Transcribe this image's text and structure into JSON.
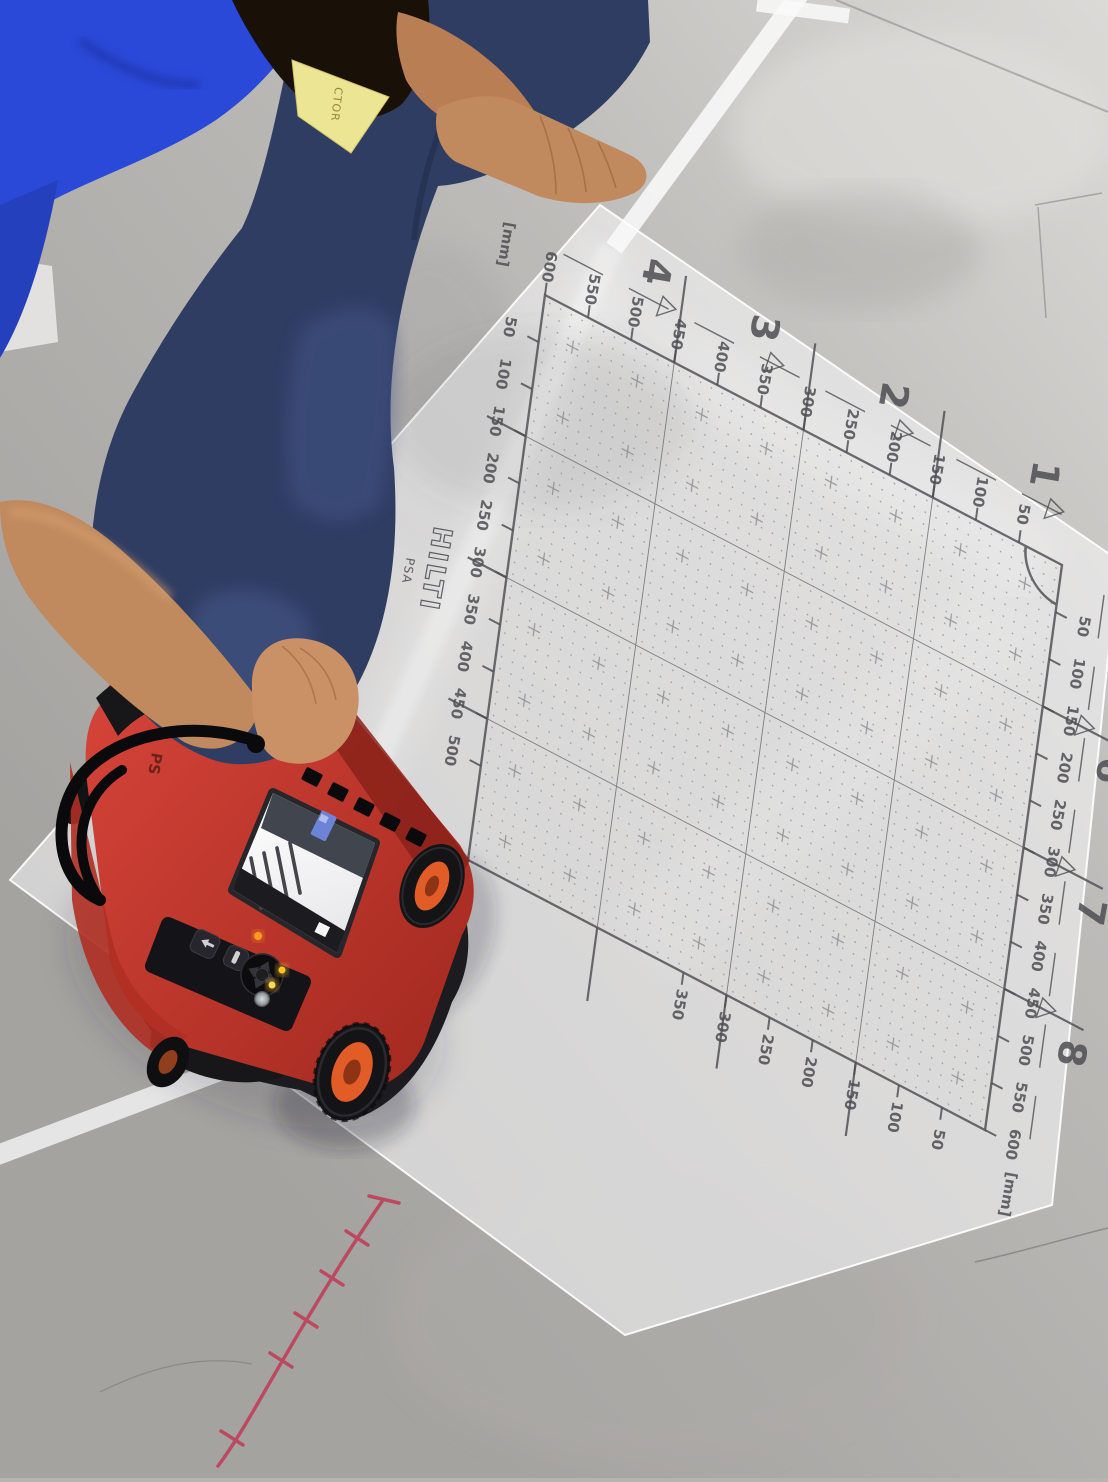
{
  "mat": {
    "brand": "HILTI",
    "series_text": "PSA",
    "unit_label": "[mm]",
    "triangle_char": "▽",
    "ink_color": "#4e4e53",
    "rulers": {
      "top": {
        "values": [
          50,
          100,
          150,
          200,
          250,
          300,
          350,
          400,
          450,
          500,
          550,
          600
        ],
        "unit_at_end": true
      },
      "right": {
        "values": [
          50,
          100,
          150,
          200,
          250,
          300,
          350,
          400,
          450,
          500,
          550,
          600
        ],
        "unit_at_end": true
      },
      "left": {
        "values": [
          50,
          100,
          150,
          200,
          250,
          300,
          350,
          400,
          450,
          500
        ],
        "unit_at_end": false
      },
      "bottom": {
        "values": [
          50,
          100,
          150,
          200,
          250,
          300,
          350
        ],
        "unit_at_end": false
      }
    },
    "sections_top": [
      {
        "label": "1",
        "u": 35
      },
      {
        "label": "2",
        "u": 210
      },
      {
        "label": "3",
        "u": 360
      },
      {
        "label": "4",
        "u": 485
      }
    ],
    "sections_right": [
      {
        "label": "6",
        "v": 180
      },
      {
        "label": "7",
        "v": 330
      },
      {
        "label": "8",
        "v": 480
      }
    ]
  },
  "device": {
    "marking": "PS",
    "body_color": "#c23327",
    "wheel_hub_color": "#e25c28",
    "led_colors": [
      "#ffc225",
      "#ffc225",
      "#ff9a20"
    ]
  },
  "badge": {
    "visible_text": "CTOR",
    "color": "#ece594"
  },
  "floor": {
    "chalk_mark_color": "#bf3a55",
    "tape_color": "#fafafa",
    "base_color": "#b6b4b1"
  }
}
